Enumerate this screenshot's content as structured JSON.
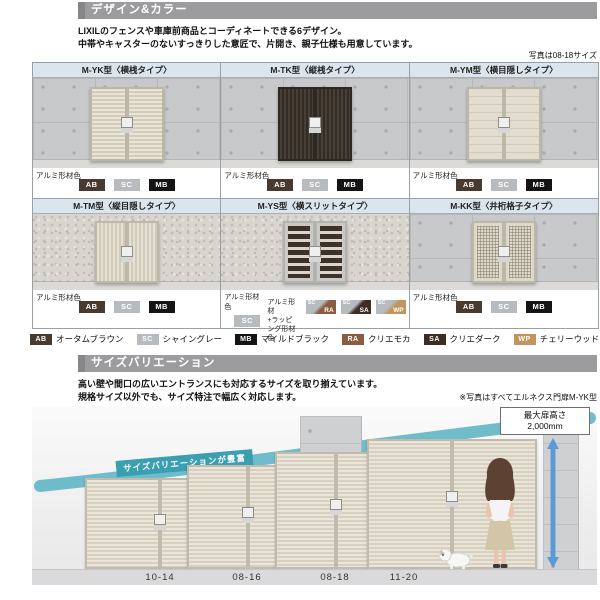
{
  "design_section": {
    "title": "デザイン&カラー",
    "intro_line1": "LIXILのフェンスや車庫前商品とコーディネートできる6デザイン。",
    "intro_line2": "中帯やキャスターのないすっきりした意匠で、片開き、親子仕様も用意しています。",
    "photo_note": "写真は08-18サイズ",
    "material_label": "アルミ形材色",
    "wrap_material_label_line1": "アルミ形材",
    "wrap_material_label_line2": "+ラッピング形材色",
    "models": [
      {
        "name": "M-YK型〈横桟タイプ〉",
        "chips": [
          "AB",
          "SC",
          "MB"
        ]
      },
      {
        "name": "M-TK型〈縦桟タイプ〉",
        "chips": [
          "AB",
          "SC",
          "MB"
        ]
      },
      {
        "name": "M-YM型〈横目隠しタイプ〉",
        "chips": [
          "AB",
          "SC",
          "MB"
        ]
      },
      {
        "name": "M-TM型〈縦目隠しタイプ〉",
        "chips": [
          "AB",
          "SC",
          "MB"
        ]
      },
      {
        "name": "M-YS型〈横スリットタイプ〉",
        "chips": [
          "SC"
        ],
        "wrap_chips": [
          {
            "top": "SC",
            "code": "RA"
          },
          {
            "top": "SC",
            "code": "SA"
          },
          {
            "top": "SC",
            "code": "WP"
          }
        ]
      },
      {
        "name": "M-KK型〈井桁格子タイプ〉",
        "chips": [
          "AB",
          "SC",
          "MB"
        ]
      }
    ],
    "legend": [
      {
        "code": "AB",
        "label": "オータムブラウン",
        "hex": "#493a2f"
      },
      {
        "code": "SC",
        "label": "シャイングレー",
        "hex": "#b7bbbf"
      },
      {
        "code": "MB",
        "label": "マイルドブラック",
        "hex": "#141414"
      },
      {
        "code": "RA",
        "label": "クリエモカ",
        "hex": "#8c5c41"
      },
      {
        "code": "SA",
        "label": "クリエダーク",
        "hex": "#3c2d25"
      },
      {
        "code": "WP",
        "label": "チェリーウッド",
        "hex": "#c2955c"
      }
    ]
  },
  "size_section": {
    "title": "サイズバリエーション",
    "intro_line1": "高い壁や間口の広いエントランスにも対応するサイズを取り揃えています。",
    "intro_line2": "規格サイズ以外でも、サイズ特注で幅広く対応します。",
    "photo_note": "※写真はすべてエルネクス門扉M-YK型",
    "swoosh_label": "サイズバリエーションが豊富",
    "max_height_label": "最大扉高さ",
    "max_height_value": "2,000mm",
    "sizes": [
      "10-14",
      "08-16",
      "08-18",
      "11-20"
    ],
    "swoosh_color": "#57b1c3",
    "arrow_color": "#5b9bd5"
  }
}
